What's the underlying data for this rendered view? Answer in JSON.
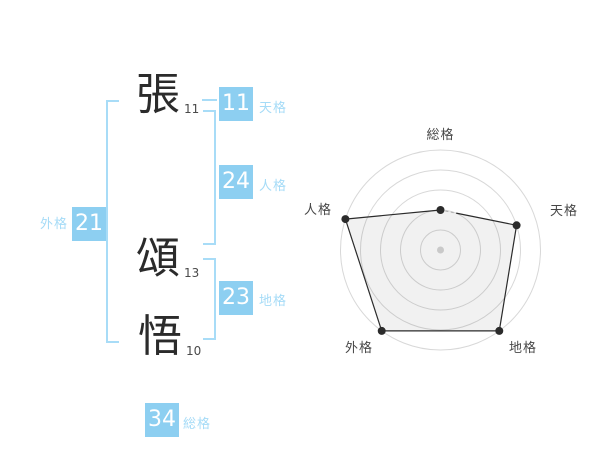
{
  "name_analysis": {
    "characters": [
      {
        "char": "張",
        "strokes": "11"
      },
      {
        "char": "頌",
        "strokes": "13"
      },
      {
        "char": "悟",
        "strokes": "10"
      }
    ],
    "badges": {
      "tenkaku": {
        "value": "11",
        "label": "天格"
      },
      "jinkaku": {
        "value": "24",
        "label": "人格"
      },
      "chikaku": {
        "value": "23",
        "label": "地格"
      },
      "gaikaku": {
        "value": "21",
        "label": "外格"
      },
      "soukaku": {
        "value": "34",
        "label": "総格"
      }
    }
  },
  "chart_data": {
    "type": "radar",
    "categories": [
      "総格",
      "天格",
      "地格",
      "外格",
      "人格"
    ],
    "values": [
      2,
      4,
      5,
      5,
      5
    ],
    "max": 5,
    "rings": 5,
    "title": "",
    "layout": "five axes, 総格 at top then clockwise 天格 地格 外格 人格, circular gridlines, no legend"
  },
  "colors": {
    "accent_blue": "#8dcff1",
    "label_blue": "#a5dbf7",
    "bracket_blue": "#a8dcf7",
    "text_dark": "#2b2b2b",
    "radar_grid": "#d8d8d8",
    "radar_line": "#2b2b2b",
    "radar_fill": "rgba(0,0,0,0.055)",
    "center_dot": "#c9c9c9"
  }
}
